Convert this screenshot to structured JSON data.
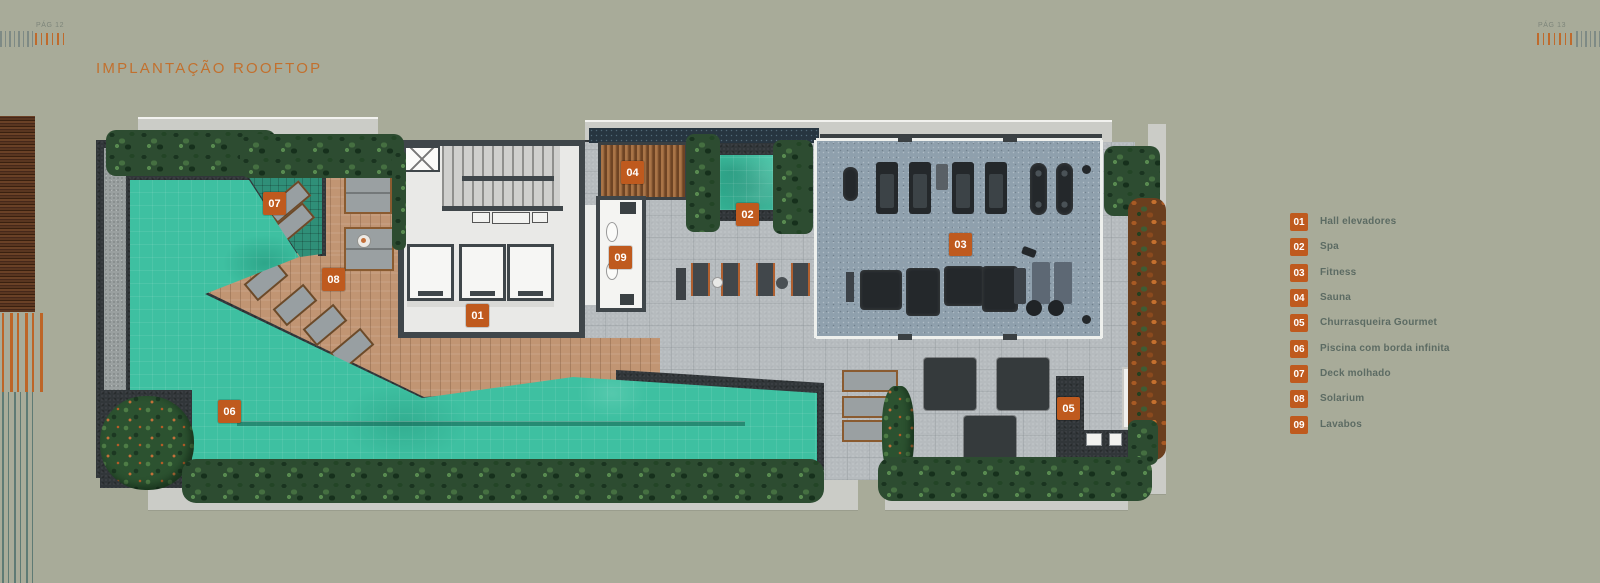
{
  "header": {
    "left_page": "PÁG 12",
    "right_page": "PÁG 13",
    "title": "IMPLANTAÇÃO ROOFTOP"
  },
  "legend": {
    "items": [
      {
        "num": "01",
        "label": "Hall elevadores"
      },
      {
        "num": "02",
        "label": "Spa"
      },
      {
        "num": "03",
        "label": "Fitness"
      },
      {
        "num": "04",
        "label": "Sauna"
      },
      {
        "num": "05",
        "label": "Churrasqueira Gourmet"
      },
      {
        "num": "06",
        "label": "Piscina com borda infinita"
      },
      {
        "num": "07",
        "label": "Deck molhado"
      },
      {
        "num": "08",
        "label": "Solarium"
      },
      {
        "num": "09",
        "label": "Lavabos"
      }
    ]
  },
  "plan": {
    "badges": [
      "01",
      "02",
      "03",
      "04",
      "05",
      "06",
      "07",
      "08",
      "09"
    ]
  },
  "colors": {
    "background": "#a8ab99",
    "badge_orange": "#bf5a1e",
    "title_orange": "#c2702e",
    "legend_text": "#5c6b63",
    "pool_teal": "#3ec0a1"
  }
}
